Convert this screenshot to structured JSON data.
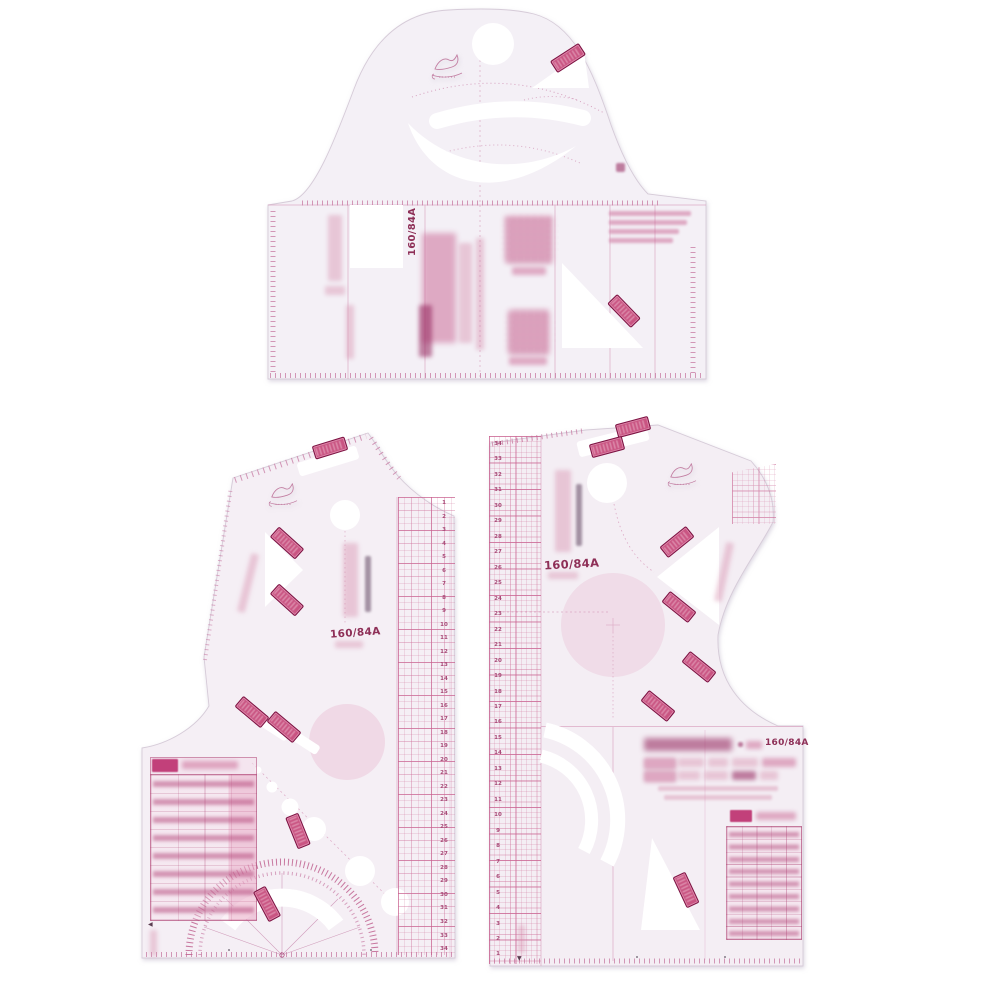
{
  "colors": {
    "background": "#ffffff",
    "plastic": "#f4f0f6",
    "plastic_edge": "#d6cbd8",
    "marking_pink": "#c9769f",
    "marking_dark": "#8e2f57",
    "stamp_fill": "#c95482",
    "stamp_border": "#7c1242"
  },
  "top_template": {
    "size_label": "160/84A"
  },
  "bottom_left_template": {
    "size_label": "160/84A",
    "corner_arrow": "◀",
    "ruler_numbers": [
      "1",
      "2",
      "3",
      "4",
      "5",
      "6",
      "7",
      "8",
      "9",
      "10",
      "11",
      "12",
      "13",
      "14",
      "15",
      "16",
      "17",
      "18",
      "19",
      "20",
      "21",
      "22",
      "23",
      "24",
      "25",
      "26",
      "27",
      "28",
      "29",
      "30",
      "31",
      "32",
      "33",
      "34"
    ]
  },
  "bottom_right_template": {
    "size_label": "160/84A",
    "model_value": "160/84A",
    "corner_arrow": "▼",
    "ruler_numbers": [
      "34",
      "33",
      "32",
      "31",
      "30",
      "29",
      "28",
      "27",
      "26",
      "25",
      "24",
      "23",
      "22",
      "21",
      "20",
      "19",
      "18",
      "17",
      "16",
      "15",
      "14",
      "13",
      "12",
      "11",
      "10",
      "9",
      "8",
      "7",
      "6",
      "5",
      "4",
      "3",
      "2",
      "1"
    ]
  }
}
